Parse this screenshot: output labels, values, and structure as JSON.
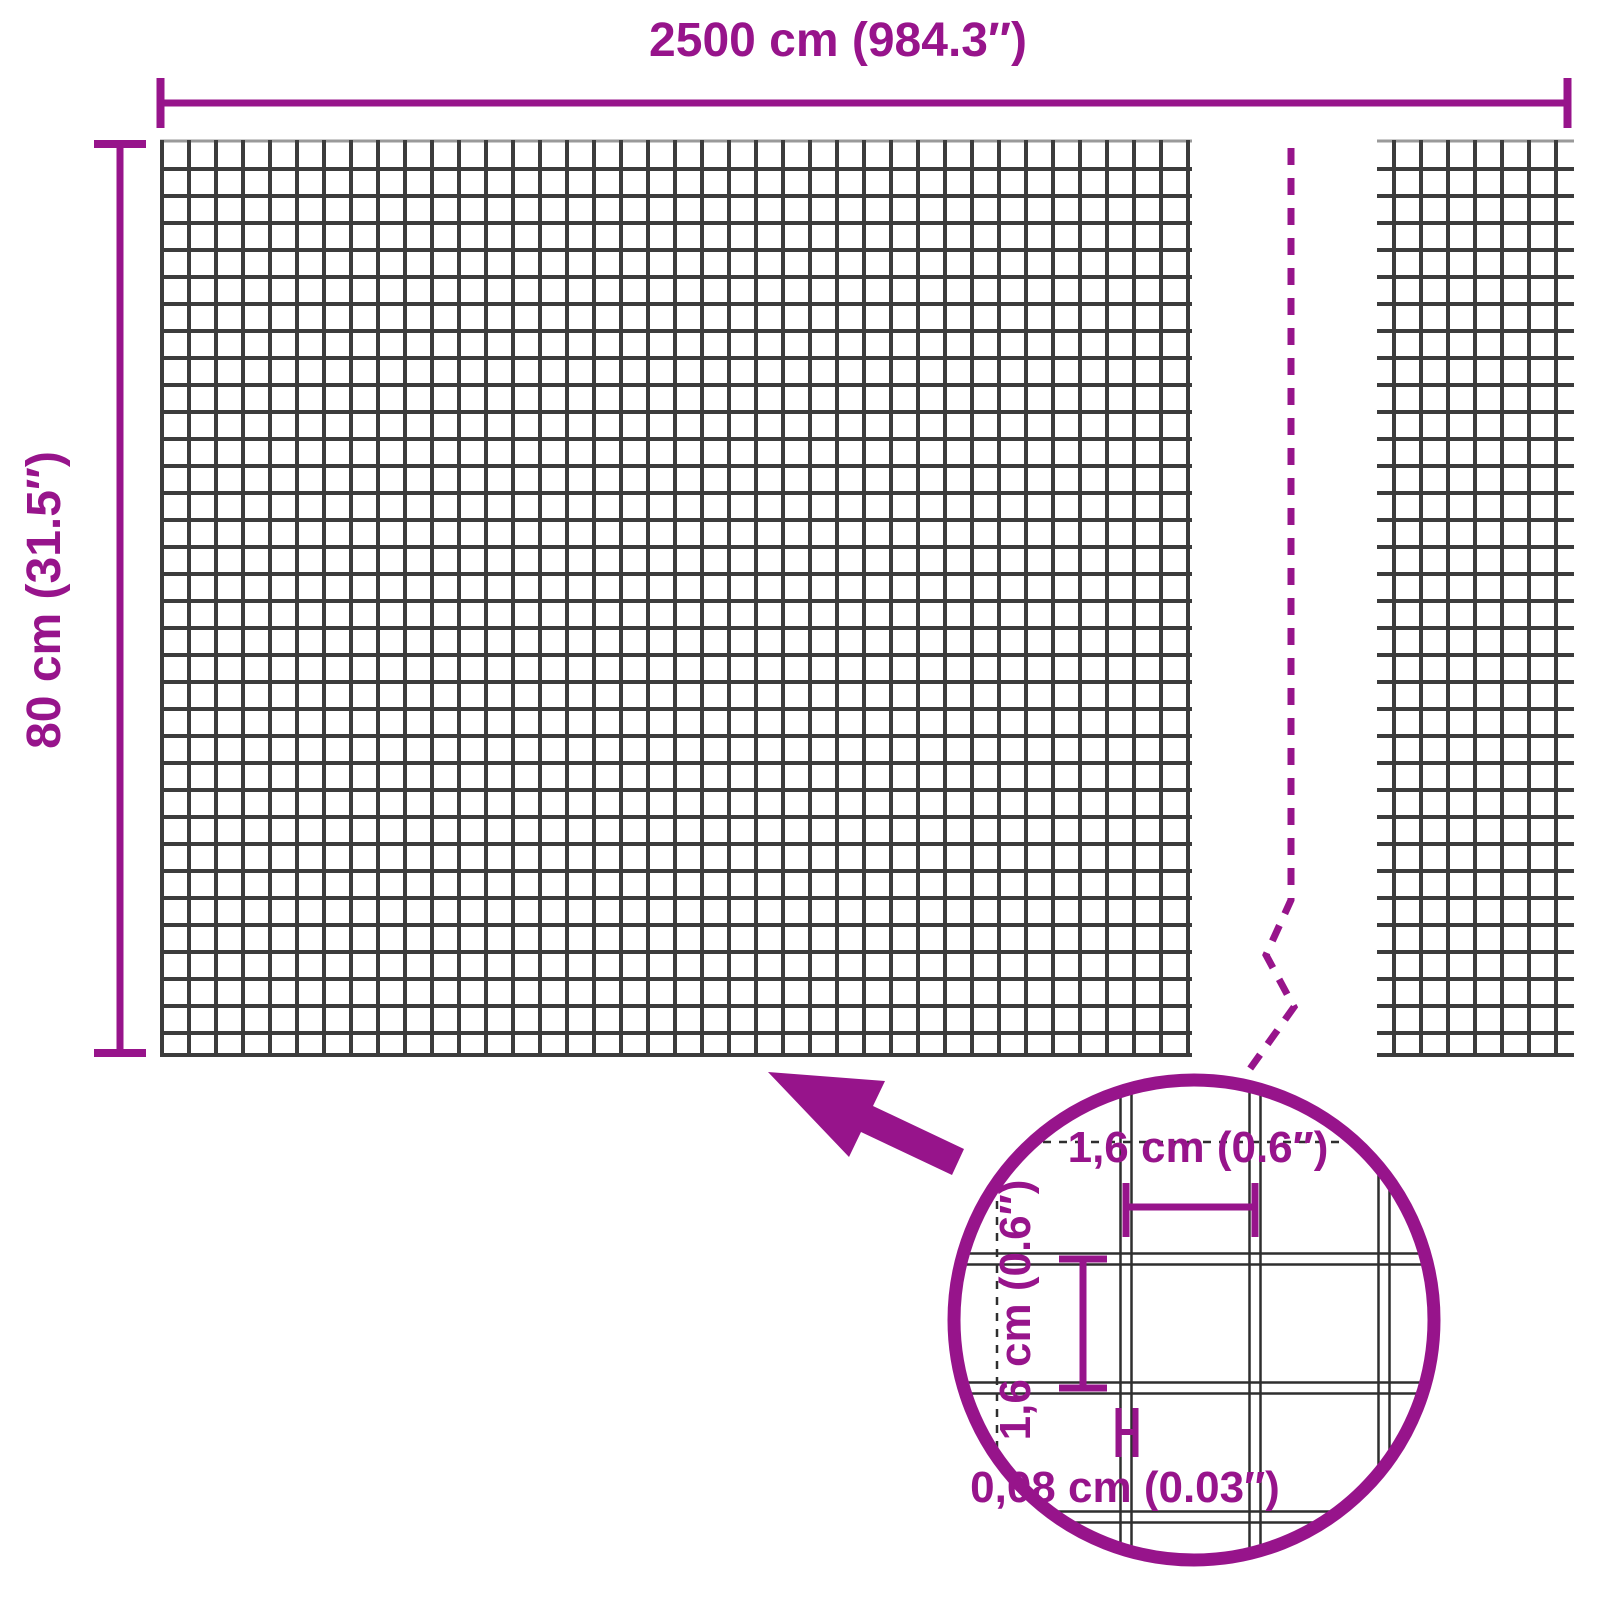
{
  "diagram": {
    "kind": "wire-mesh-dimension-diagram",
    "overall_width": {
      "label": "2500 cm (984.3″)"
    },
    "overall_height": {
      "label": "80 cm (31.5″)"
    },
    "detail": {
      "mesh_opening_width": {
        "label": "1,6 cm (0.6″)"
      },
      "mesh_opening_height": {
        "label": "1,6 cm (0.6″)"
      },
      "wire_thickness": {
        "label": "0,08 cm (0.03″)"
      }
    },
    "colors": {
      "accent": "#97148B",
      "mesh_line": "#3C3C3C",
      "mesh_edge_light": "#9A9A9A",
      "detail_wire": "#2F2F2F",
      "background": "#FFFFFF"
    }
  }
}
